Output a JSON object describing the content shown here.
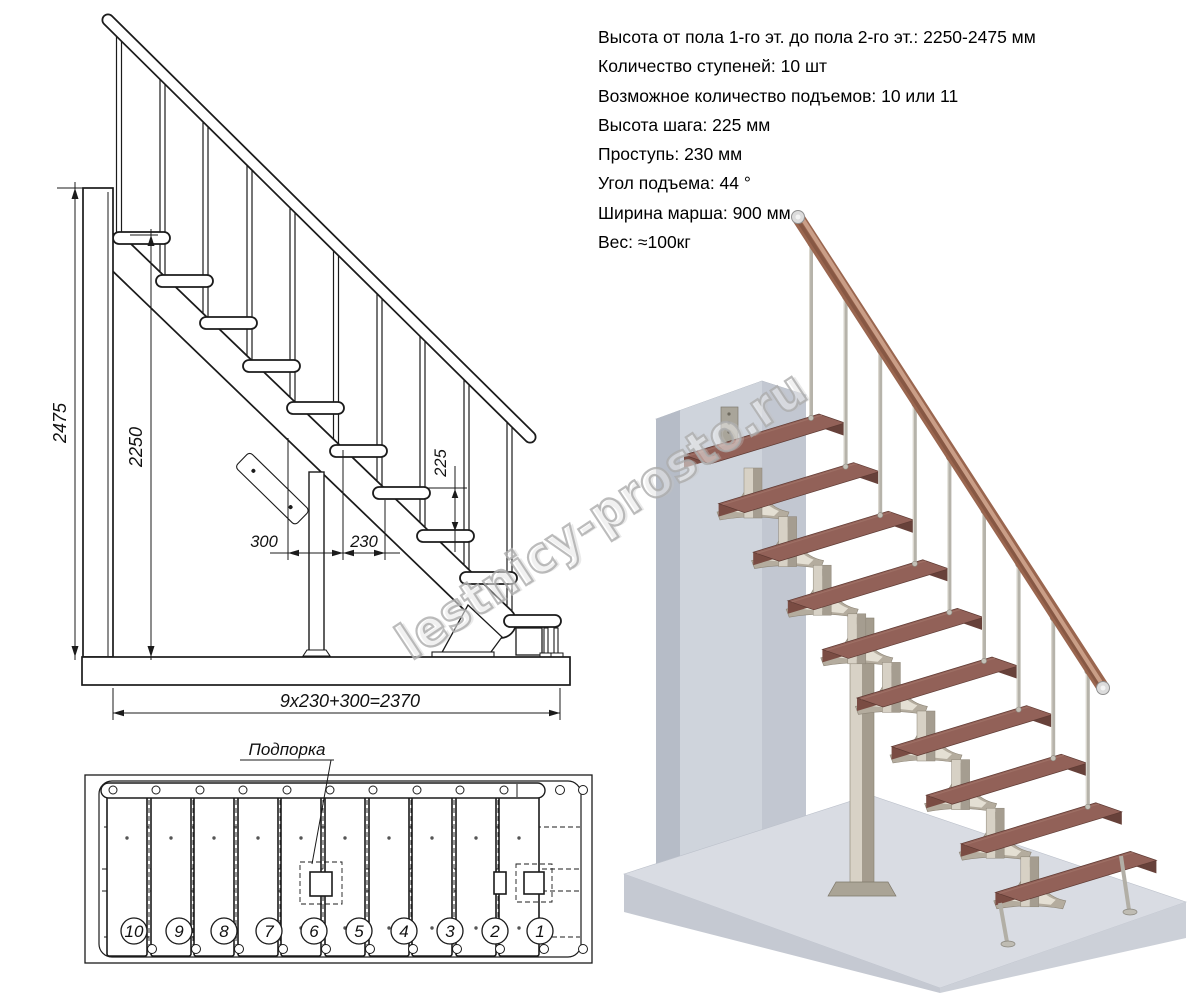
{
  "specs": {
    "lines": [
      "Высота от пола 1-го эт. до пола 2-го эт.: 2250-2475 мм",
      "Количество ступеней: 10 шт",
      "Возможное количество подъемов: 10 или 11",
      "Высота шага: 225 мм",
      "Проступь: 230 мм",
      "Угол подъема: 44 °",
      "Ширина марша: 900 мм",
      "Вес: ≈100кг"
    ]
  },
  "elevation": {
    "dims": {
      "total_height": "2475",
      "floor_height": "2250",
      "rise": "225",
      "bottom_run": "300",
      "tread_run": "230",
      "total_run": "9x230+300=2370"
    }
  },
  "plan": {
    "support_label": "Подпорка",
    "step_numbers": [
      "10",
      "9",
      "8",
      "7",
      "6",
      "5",
      "4",
      "3",
      "2",
      "1"
    ]
  },
  "watermark": {
    "text": "lestnicy-prosto.ru"
  },
  "colors": {
    "line": "#1b1b1b",
    "tread_top": "#926158",
    "tread_front": "#7a4c43",
    "tread_side": "#67413a",
    "handrail": "#9a664f",
    "metal": "#b6b3aa",
    "structure": "#b4ac9e",
    "wall": "#cfd4dc",
    "floor": "#d9dce3"
  }
}
